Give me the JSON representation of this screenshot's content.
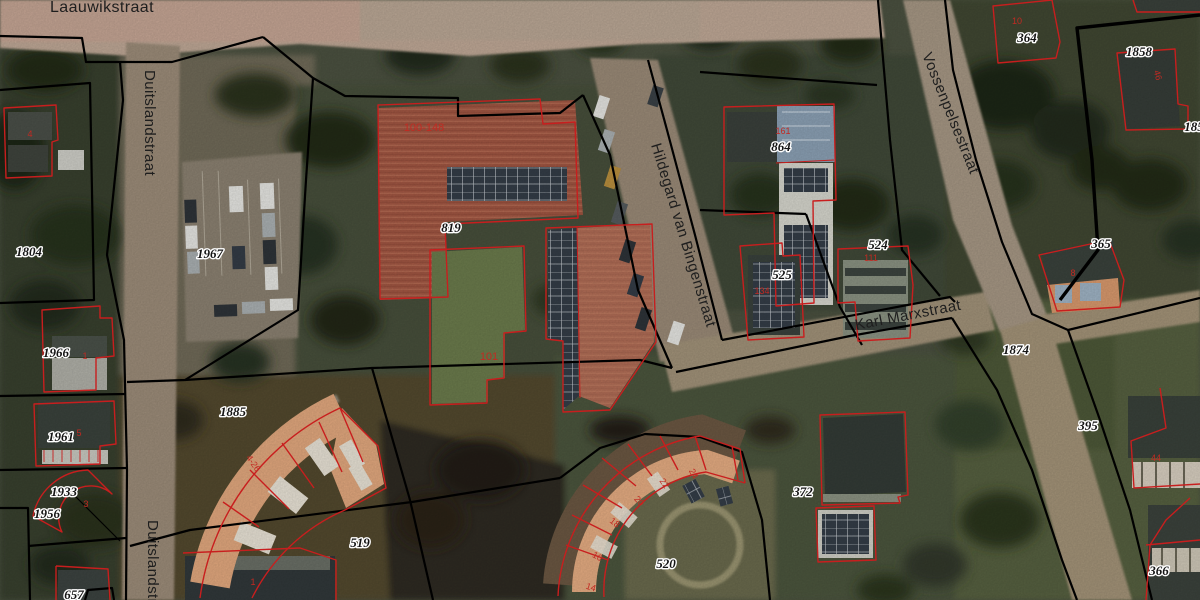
{
  "map": {
    "streets": {
      "laauwikstraat": "Laauwikstraat",
      "duitslandstraat": "Duitslandstraat",
      "duitslandstraat2": "Duitslandstraat",
      "hildegard": "Hildegard van Bingenstraat",
      "karl_marx": "Karl Marxstraat",
      "vossenpelsestraat": "Vossenpelsestraat"
    },
    "parcels": {
      "p1804": "1804",
      "p1967": "1967",
      "p1966": "1966",
      "p1961": "1961",
      "p1933": "1933",
      "p1956": "1956",
      "p657": "657",
      "p1885": "1885",
      "p519": "519",
      "p819": "819",
      "p864": "864",
      "p525": "525",
      "p524": "524",
      "p520": "520",
      "p372": "372",
      "p364": "364",
      "p1858": "1858",
      "p185": "185",
      "p365": "365",
      "p1874": "1874",
      "p395": "395",
      "p366": "366"
    },
    "house_numbers": {
      "h100_148": "100-148",
      "h101": "101",
      "h4_26": "4-26",
      "h24": "24",
      "h22": "22",
      "h20": "20",
      "h18": "18",
      "h16": "16",
      "h14": "14",
      "h161": "161",
      "h134": "134",
      "h111": "111",
      "h10": "10",
      "h46": "46",
      "h8": "8",
      "h44": "44",
      "h3": "3",
      "h1": "1",
      "h5": "5",
      "h1b": "1",
      "h4": "4"
    },
    "colors": {
      "parcel_boundary": "#000000",
      "building_outline": "#c81e1e",
      "house_number": "#c22a22",
      "parcel_label": "#141414",
      "label_halo": "#ffffff",
      "street_label": "#1e1e1e",
      "road": "#9c8c79",
      "roof_tile": "#a25743",
      "roof_orange": "#e2a87e"
    }
  }
}
